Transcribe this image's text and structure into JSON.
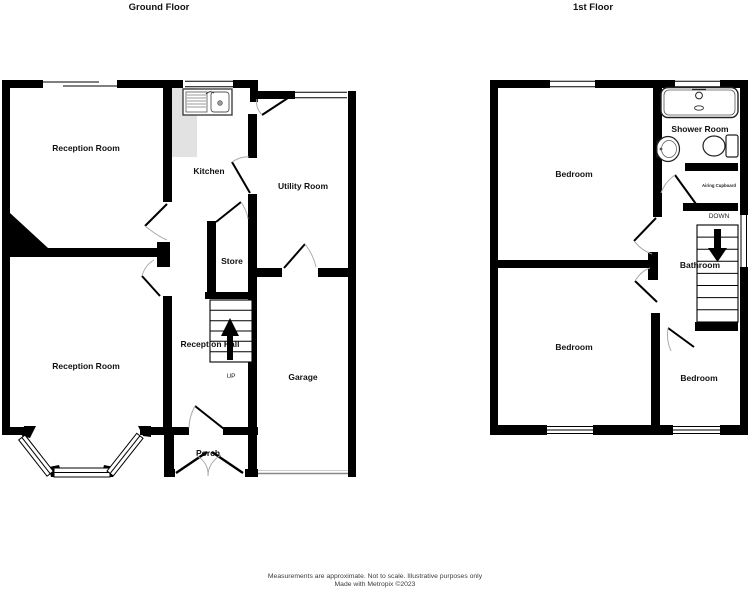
{
  "ground": {
    "title": "Ground Floor",
    "reception_top": "Reception Room",
    "kitchen": "Kitchen",
    "utility": "Utility Room",
    "store": "Store",
    "hall": "Reception Hall",
    "up": "UP",
    "reception_bottom": "Reception Room",
    "garage": "Garage",
    "porch": "Porch"
  },
  "first": {
    "title": "1st Floor",
    "bedroom_top": "Bedroom",
    "shower_room": "Shower Room",
    "airing_cupboard": "Airing Cupboard",
    "down": "DOWN",
    "bathroom": "Bathroom",
    "bedroom_left": "Bedroom",
    "bedroom_right": "Bedroom"
  },
  "footer": {
    "line1": "Measurements are approximate.  Not to scale.  Illustrative purposes only",
    "line2": "Made with Metropix ©2023"
  },
  "colors": {
    "wall": "#000000",
    "counter": "#e2e2e2",
    "swing_arc": "#aaaaaa",
    "garage_door": "#888888",
    "text": "#111111",
    "footer_text": "#3c3c3c"
  }
}
